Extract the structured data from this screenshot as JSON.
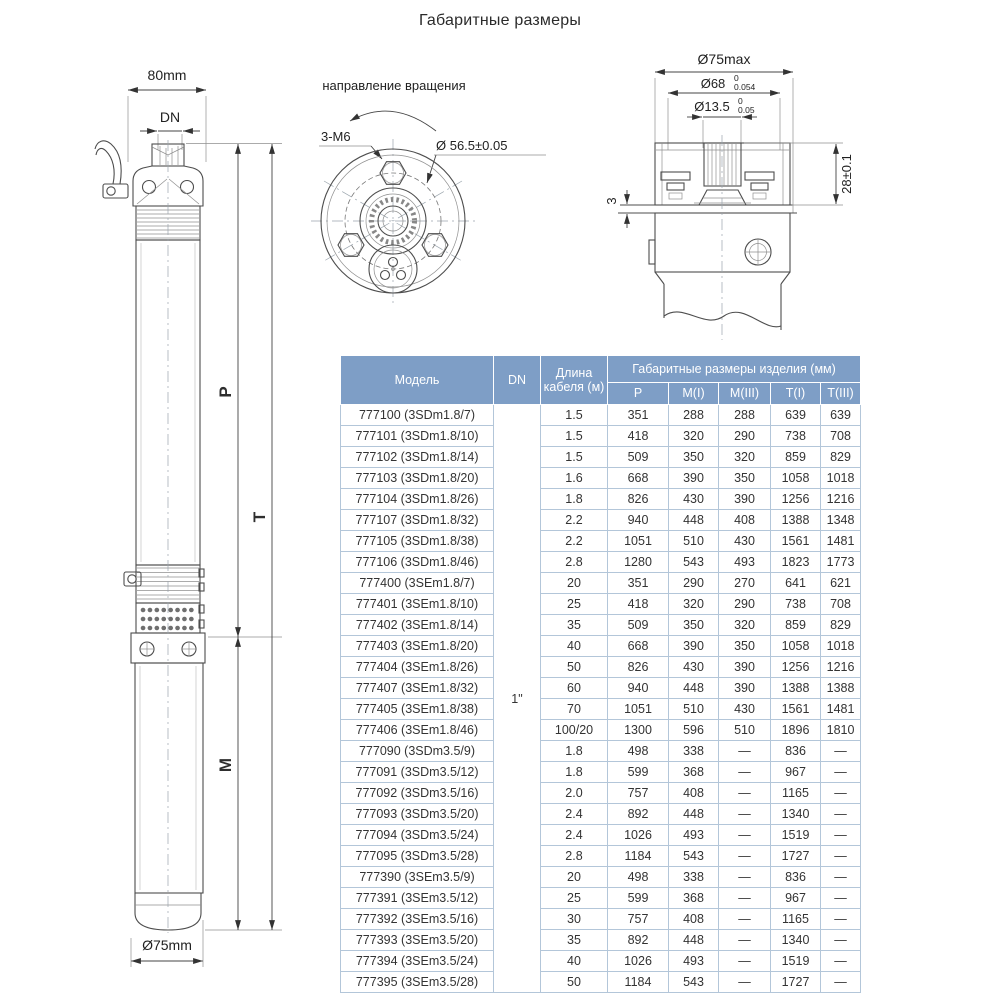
{
  "title": "Габаритные размеры",
  "left_view": {
    "top_width": "80mm",
    "outlet": "DN",
    "p": "P",
    "t": "T",
    "m": "M",
    "bottom_diameter": "Ø75mm"
  },
  "rotation_view": {
    "direction": "направление вращения",
    "thread": "3-М6",
    "bolt_circle": "Ø 56.5±0.05"
  },
  "top_view": {
    "max_diameter": "Ø75max",
    "d68": "Ø68",
    "d68_tol_upper": "0",
    "d68_tol_lower": "0.054",
    "d135": "Ø13.5",
    "d135_tol_upper": "0",
    "d135_tol_lower": "0.05",
    "shaft_height": "28±0.1",
    "gap": "3"
  },
  "table": {
    "col_model": "Модель",
    "col_dn": "DN",
    "col_cable": "Длина кабеля (м)",
    "col_dims_group": "Габаритные размеры изделия (мм)",
    "col_p": "P",
    "col_m1": "M(I)",
    "col_m3": "M(III)",
    "col_t1": "T(I)",
    "col_t3": "T(III)",
    "dn_value": "1\"",
    "rows": [
      {
        "model": "777100 (3SDm1.8/7)",
        "cable": "1.5",
        "p": "351",
        "m1": "288",
        "m3": "288",
        "t1": "639",
        "t3": "639"
      },
      {
        "model": "777101 (3SDm1.8/10)",
        "cable": "1.5",
        "p": "418",
        "m1": "320",
        "m3": "290",
        "t1": "738",
        "t3": "708"
      },
      {
        "model": "777102 (3SDm1.8/14)",
        "cable": "1.5",
        "p": "509",
        "m1": "350",
        "m3": "320",
        "t1": "859",
        "t3": "829"
      },
      {
        "model": "777103 (3SDm1.8/20)",
        "cable": "1.6",
        "p": "668",
        "m1": "390",
        "m3": "350",
        "t1": "1058",
        "t3": "1018"
      },
      {
        "model": "777104 (3SDm1.8/26)",
        "cable": "1.8",
        "p": "826",
        "m1": "430",
        "m3": "390",
        "t1": "1256",
        "t3": "1216"
      },
      {
        "model": "777107 (3SDm1.8/32)",
        "cable": "2.2",
        "p": "940",
        "m1": "448",
        "m3": "408",
        "t1": "1388",
        "t3": "1348"
      },
      {
        "model": "777105 (3SDm1.8/38)",
        "cable": "2.2",
        "p": "1051",
        "m1": "510",
        "m3": "430",
        "t1": "1561",
        "t3": "1481"
      },
      {
        "model": "777106 (3SDm1.8/46)",
        "cable": "2.8",
        "p": "1280",
        "m1": "543",
        "m3": "493",
        "t1": "1823",
        "t3": "1773"
      },
      {
        "model": "777400 (3SEm1.8/7)",
        "cable": "20",
        "p": "351",
        "m1": "290",
        "m3": "270",
        "t1": "641",
        "t3": "621"
      },
      {
        "model": "777401 (3SEm1.8/10)",
        "cable": "25",
        "p": "418",
        "m1": "320",
        "m3": "290",
        "t1": "738",
        "t3": "708"
      },
      {
        "model": "777402 (3SEm1.8/14)",
        "cable": "35",
        "p": "509",
        "m1": "350",
        "m3": "320",
        "t1": "859",
        "t3": "829"
      },
      {
        "model": "777403 (3SEm1.8/20)",
        "cable": "40",
        "p": "668",
        "m1": "390",
        "m3": "350",
        "t1": "1058",
        "t3": "1018"
      },
      {
        "model": "777404 (3SEm1.8/26)",
        "cable": "50",
        "p": "826",
        "m1": "430",
        "m3": "390",
        "t1": "1256",
        "t3": "1216"
      },
      {
        "model": "777407 (3SEm1.8/32)",
        "cable": "60",
        "p": "940",
        "m1": "448",
        "m3": "390",
        "t1": "1388",
        "t3": "1388"
      },
      {
        "model": "777405 (3SEm1.8/38)",
        "cable": "70",
        "p": "1051",
        "m1": "510",
        "m3": "430",
        "t1": "1561",
        "t3": "1481"
      },
      {
        "model": "777406 (3SEm1.8/46)",
        "cable": "100/20",
        "p": "1300",
        "m1": "596",
        "m3": "510",
        "t1": "1896",
        "t3": "1810"
      },
      {
        "model": "777090 (3SDm3.5/9)",
        "cable": "1.8",
        "p": "498",
        "m1": "338",
        "m3": "—",
        "t1": "836",
        "t3": "—"
      },
      {
        "model": "777091 (3SDm3.5/12)",
        "cable": "1.8",
        "p": "599",
        "m1": "368",
        "m3": "—",
        "t1": "967",
        "t3": "—"
      },
      {
        "model": "777092 (3SDm3.5/16)",
        "cable": "2.0",
        "p": "757",
        "m1": "408",
        "m3": "—",
        "t1": "1165",
        "t3": "—"
      },
      {
        "model": "777093 (3SDm3.5/20)",
        "cable": "2.4",
        "p": "892",
        "m1": "448",
        "m3": "—",
        "t1": "1340",
        "t3": "—"
      },
      {
        "model": "777094 (3SDm3.5/24)",
        "cable": "2.4",
        "p": "1026",
        "m1": "493",
        "m3": "—",
        "t1": "1519",
        "t3": "—"
      },
      {
        "model": "777095 (3SDm3.5/28)",
        "cable": "2.8",
        "p": "1184",
        "m1": "543",
        "m3": "—",
        "t1": "1727",
        "t3": "—"
      },
      {
        "model": "777390 (3SEm3.5/9)",
        "cable": "20",
        "p": "498",
        "m1": "338",
        "m3": "—",
        "t1": "836",
        "t3": "—"
      },
      {
        "model": "777391 (3SEm3.5/12)",
        "cable": "25",
        "p": "599",
        "m1": "368",
        "m3": "—",
        "t1": "967",
        "t3": "—"
      },
      {
        "model": "777392 (3SEm3.5/16)",
        "cable": "30",
        "p": "757",
        "m1": "408",
        "m3": "—",
        "t1": "1165",
        "t3": "—"
      },
      {
        "model": "777393 (3SEm3.5/20)",
        "cable": "35",
        "p": "892",
        "m1": "448",
        "m3": "—",
        "t1": "1340",
        "t3": "—"
      },
      {
        "model": "777394 (3SEm3.5/24)",
        "cable": "40",
        "p": "1026",
        "m1": "493",
        "m3": "—",
        "t1": "1519",
        "t3": "—"
      },
      {
        "model": "777395 (3SEm3.5/28)",
        "cable": "50",
        "p": "1184",
        "m1": "543",
        "m3": "—",
        "t1": "1727",
        "t3": "—"
      }
    ]
  }
}
